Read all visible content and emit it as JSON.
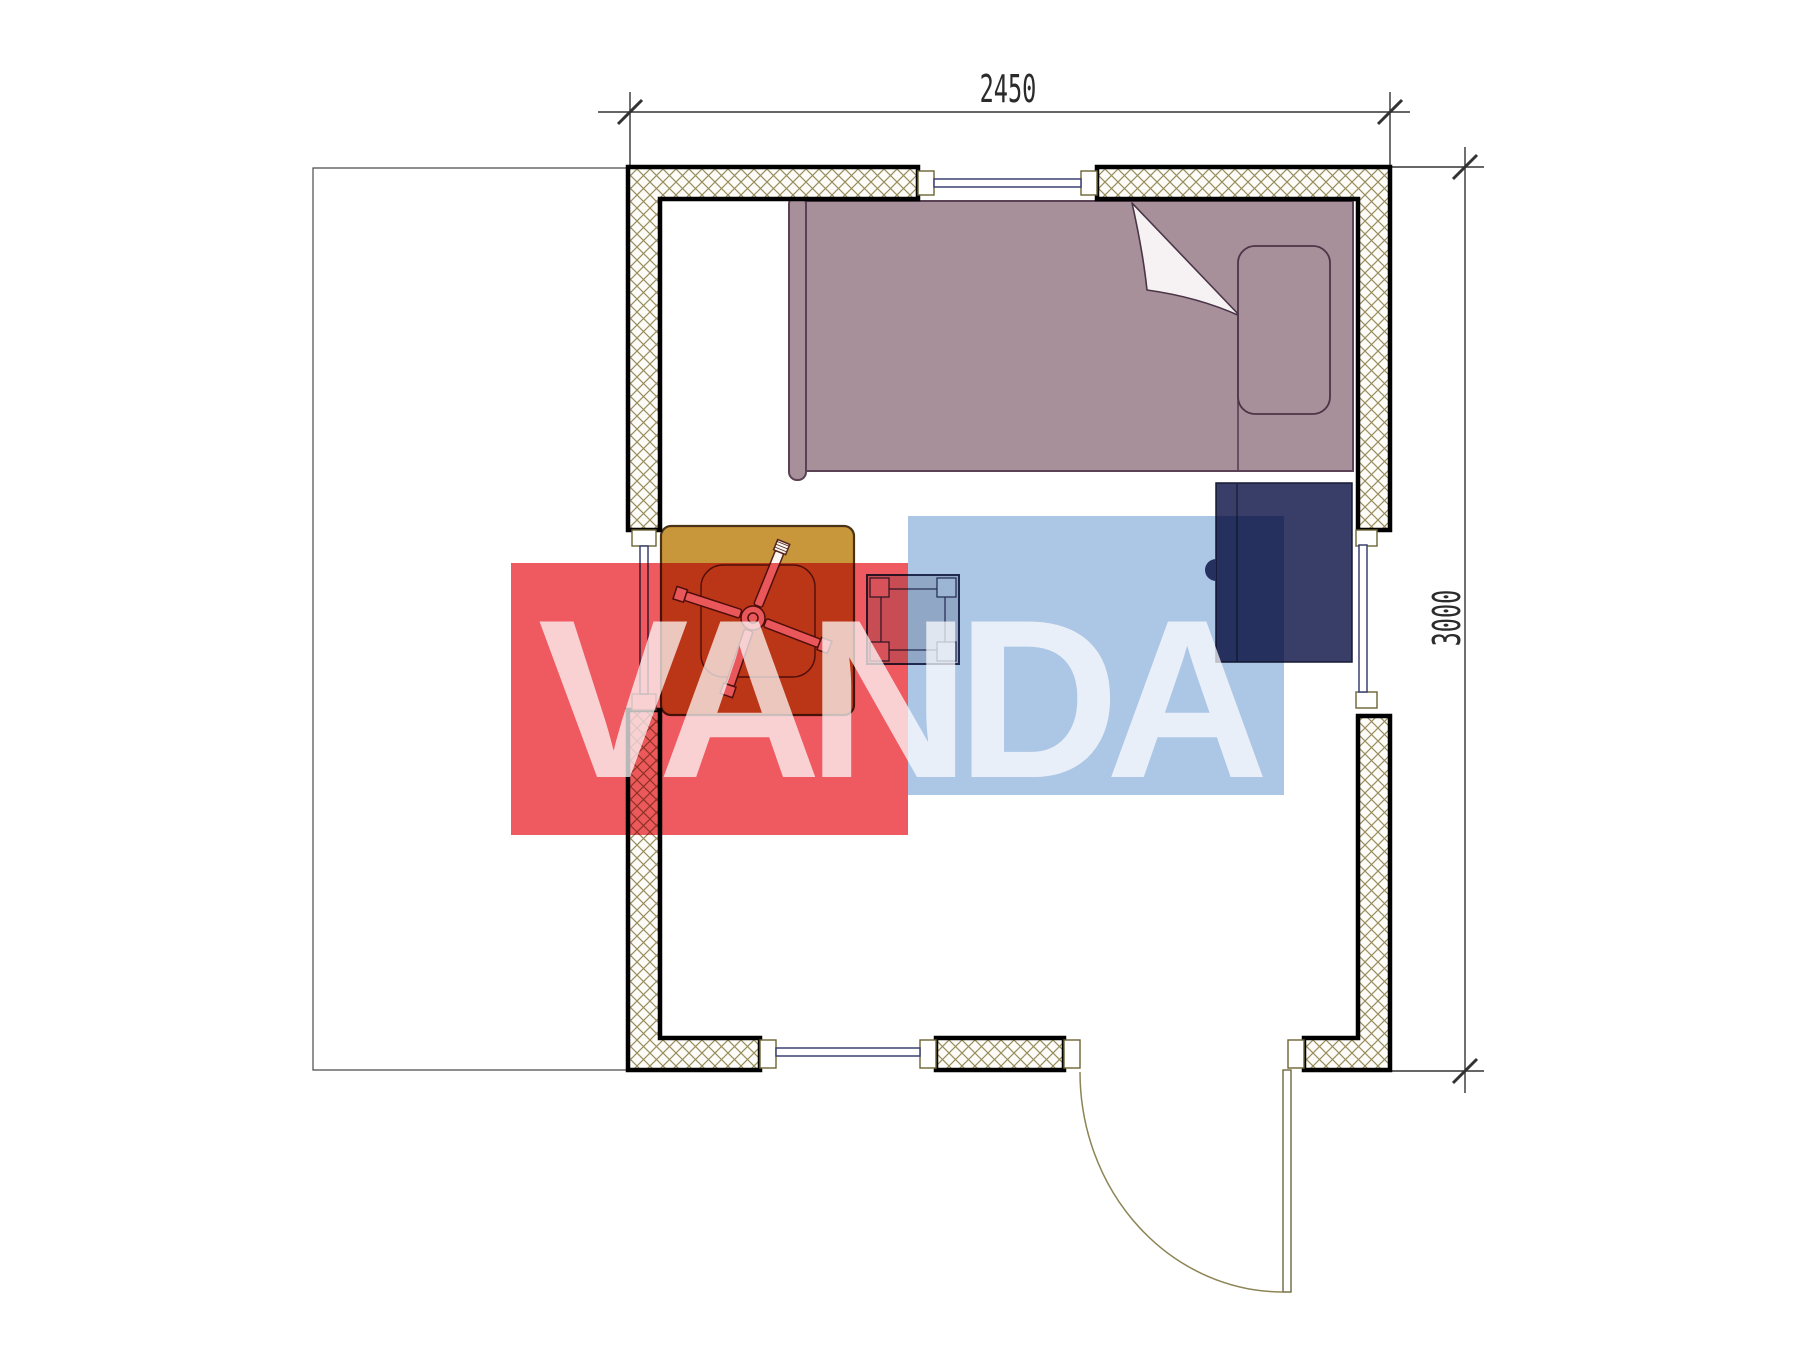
{
  "drawing": {
    "type": "architectural floor plan (top view of a small cabin room)",
    "dimension_labels": {
      "top": "2450",
      "right": "3000"
    },
    "watermark": {
      "text": "VANDA",
      "red_block_color": "#EE5A60",
      "blue_block_color": "#ACC6E5"
    },
    "palette": {
      "bed_fill": "#A8909B",
      "bed_outline": "#5A4154",
      "wardrobe_fill": "#383E68",
      "table_fill": "#C9973B",
      "stool_fill": "#D6D7DC",
      "wall_hatch": "#978C5B",
      "wall_border": "#000000",
      "window_line": "#3A4070",
      "door_line": "#8C8455",
      "dimension_line": "#333333"
    },
    "elements": [
      "insulated exterior walls with cross hatch",
      "window in top wall",
      "window in left wall",
      "window in right wall",
      "window in bottom wall",
      "entry door with swing arc at bottom right",
      "single bed with pillow and folded blanket corner",
      "dark wardrobe",
      "square table with four-blade fan",
      "small square stool",
      "terrace outline on the left"
    ]
  }
}
